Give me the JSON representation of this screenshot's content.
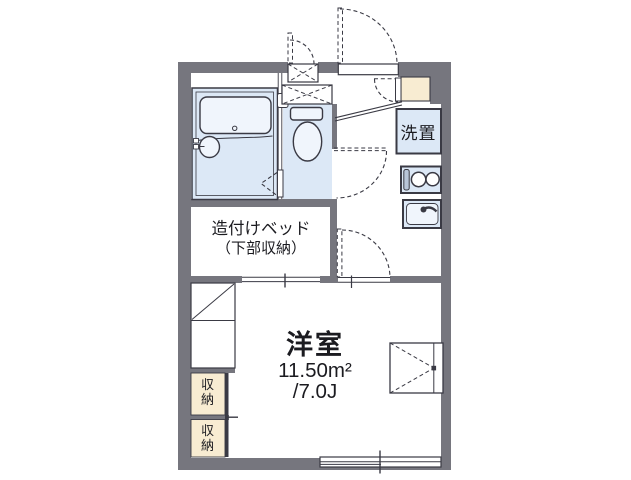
{
  "floorplan": {
    "rooms": {
      "laundry_label": "洗置",
      "bed_room": {
        "line1": "造付けベッド",
        "line2": "（下部収納）"
      },
      "main_room": {
        "name": "洋室",
        "area_m2": "11.50m²",
        "area_tatami": "/7.0J"
      },
      "storage_upper": "収納",
      "storage_lower": "収納"
    },
    "colors": {
      "wall": "#76767E",
      "line": "#3A3A44",
      "wet": "#DCE8F6",
      "fixture": "#F0F5FC",
      "cream": "#F8ECD2",
      "grill": "#B8C5D8",
      "text": "#1B1B20",
      "background": "#FFFFFF"
    }
  }
}
